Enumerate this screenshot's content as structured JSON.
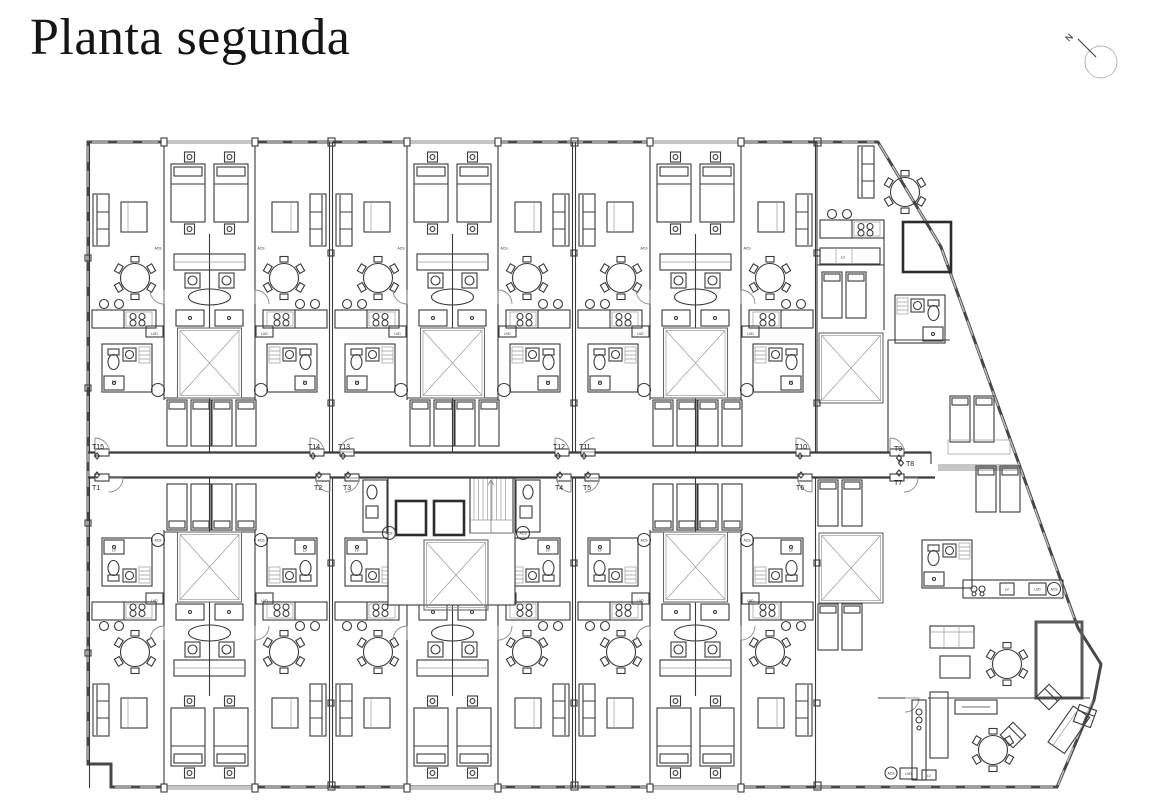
{
  "page": {
    "title": "Planta segunda"
  },
  "compass": {
    "north_label": "N"
  },
  "plan": {
    "units": {
      "t1": "T1",
      "t2": "T2",
      "t3": "T3",
      "t4": "T4",
      "t5": "T5",
      "t6": "T6",
      "t7": "T7",
      "t8": "T8",
      "t9": "T9",
      "t10": "T10",
      "t11": "T11",
      "t12": "T12",
      "t13": "T13",
      "t14": "T14",
      "t15": "T15"
    },
    "appliances": {
      "washer_dryer": "LVD",
      "dishwasher": "LV",
      "water_heater": "ACS"
    }
  }
}
